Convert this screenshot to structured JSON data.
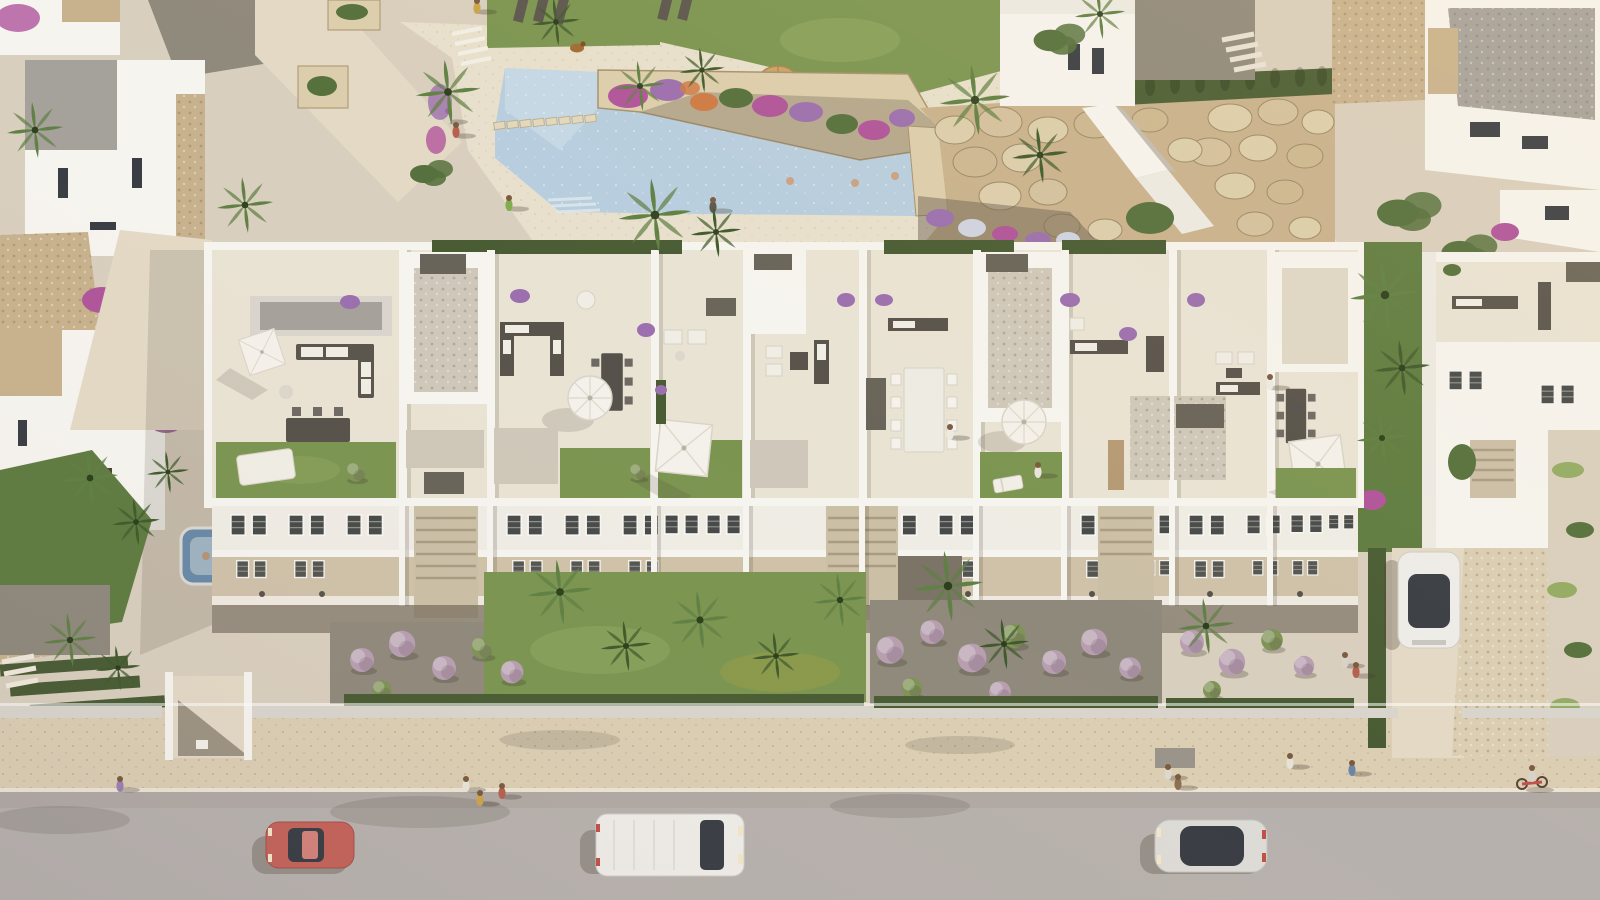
{
  "meta": {
    "title": "Aerial 3D render — Mediterranean apartment complex with roof terraces, pool and street",
    "view": "top-down oblique aerial",
    "time_of_day": "late afternoon sun, long soft shadows"
  },
  "palette": {
    "ground": "#d9cfbe",
    "path": "#e3d9c5",
    "deck": "#e8e0cd",
    "tile": "#e9e3d4",
    "tile_shade": "#ded7c6",
    "gravel": "#cfc7b9",
    "gravel_dark": "#8f897c",
    "soil": "#6e6253",
    "asphalt": "#b7b1ad",
    "sidewalk": "#dbceb3",
    "curb": "#ece4d2",
    "pool": "#b7cedf",
    "pool_light": "#cfe0ea",
    "white_sun": "#f6f4ef",
    "white": "#edeae3",
    "white_shade": "#d9d5cd",
    "wall_shadow": "#c2bcb1",
    "balcony": "#cfc2a9",
    "stair": "#cbbfa6",
    "recess": "#7c7467",
    "roof_gray": "#a5a19b",
    "stone": "#c8b28d",
    "stone_light": "#dcceac",
    "stone_dark": "#a6916e",
    "lawn": "#7b9551",
    "lawn_light": "#93ab64",
    "lawn_dark": "#5f7c40",
    "palm": "#5f8044",
    "palm_dark": "#3f5a2c",
    "hedge": "#495c33",
    "foliage": "#55703c",
    "flower_purple": "#9c6fae",
    "flower_magenta": "#b0549b",
    "flower_orange": "#cd7a45",
    "shrub_mauve": "#b79fb0",
    "shrub_green": "#7e9355",
    "box_dark": "#696459",
    "furn_dark": "#58534b",
    "cushion": "#f0ede5",
    "umbrella": "#f4f1ea",
    "straw": "#c9a266",
    "car_red": "#c4635a",
    "car_white": "#eeece8",
    "car_silver": "#dddbd7",
    "glass": "#393d43",
    "skin": "#caa183",
    "shadow": "rgba(76,66,53,0.30)",
    "shadow_soft": "rgba(76,66,53,0.16)"
  },
  "scene": {
    "pool": {
      "water_color_key": "pool",
      "shape": "angled L with stepping-stone bridge",
      "stepping_stones": 8,
      "swimmers": 3,
      "deck_people": 2,
      "planter": "raised stone planter with purple, magenta and orange flowers",
      "extras": [
        "straw parasol on lawn",
        "sun loungers",
        "duck on deck"
      ]
    },
    "main_building": {
      "roof_terraces": 8,
      "terrace_features": [
        "white square parasols",
        "octagonal parasols",
        "grey sofa sets with white cushions",
        "dark dining tables",
        "long white dining table with 8 chairs",
        "lawn patches",
        "gravel beds",
        "dark stair hatches",
        "planters with purple flowers"
      ],
      "facade": {
        "floors_visible": 3,
        "window_style": "dark slatted pairs in white frames",
        "balconies": "recessed beige balconies with white parapets",
        "stair_cores": 3
      }
    },
    "left_villas": {
      "count": 2,
      "details": [
        "stone-trimmed white walls",
        "bougainvillea",
        "blue jacuzzi with bather",
        "entrance passage to sidewalk"
      ]
    },
    "right_buildings": {
      "count": 3,
      "details": [
        "grey gravel flat roofs",
        "stone chimney",
        "driveway with parked car",
        "tall palm garden gap"
      ]
    },
    "rockery": "large beige boulder retaining slope with white switchback ramp and cypress hedge",
    "vehicles": [
      {
        "name": "red-car",
        "type": "coupe",
        "color_key": "car_red",
        "location": "street left",
        "facing": "west"
      },
      {
        "name": "white-van",
        "type": "panel van",
        "color_key": "car_white",
        "location": "street centre",
        "facing": "east"
      },
      {
        "name": "white-sedan",
        "type": "sedan, dark glass roof",
        "color_key": "car_silver",
        "location": "street right",
        "facing": "west"
      },
      {
        "name": "parked-car",
        "type": "hatchback, dark glass roof",
        "color_key": "car_white",
        "location": "right driveway",
        "facing": "north"
      }
    ],
    "people": {
      "sidewalk": 8,
      "pool_area": 7,
      "roof_terraces": 3,
      "driveway": 2,
      "cyclist": 1
    },
    "vegetation": {
      "palms": 24,
      "mauve_shrub_balls": 20,
      "hedges": "dark clipped rows along walls",
      "accents": [
        "bougainvillea",
        "lavender pots",
        "banana plants"
      ]
    }
  }
}
